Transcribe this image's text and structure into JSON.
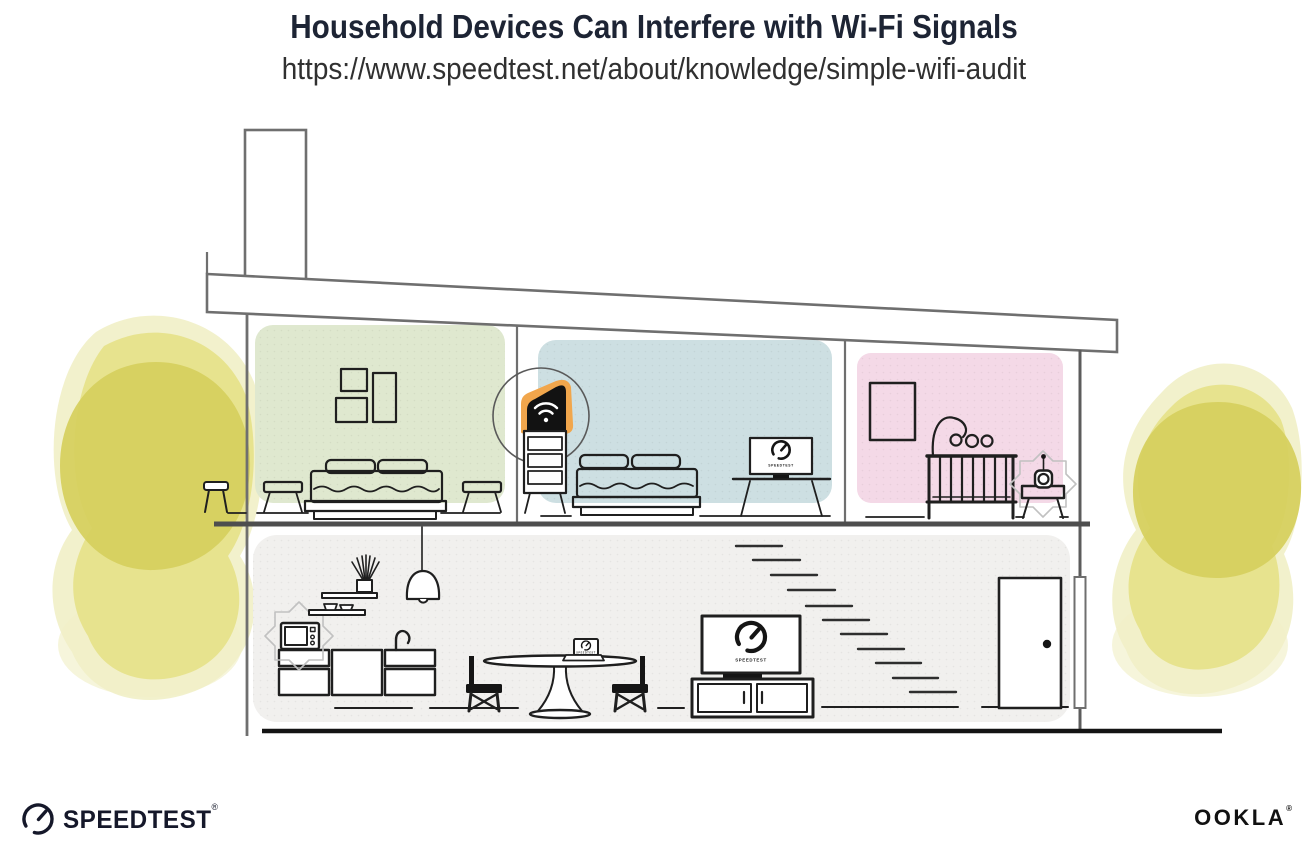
{
  "header": {
    "title": "Household Devices Can Interfere with Wi-Fi Signals",
    "url": "https://www.speedtest.net/about/knowledge/simple-wifi-audit"
  },
  "devices": {
    "tv_label": "SPEEDTEST",
    "desk_monitor_label": "SPEEDTEST",
    "laptop_label": "SPEEDTEST"
  },
  "footer": {
    "speedtest_wordmark": "SPEEDTEST",
    "speedtest_registered": "®",
    "ookla_wordmark": "OOKLA",
    "ookla_registered": "®"
  },
  "colors": {
    "title_text": "#1d2434",
    "url_text": "#303030",
    "outline_ink": "#1f1f1f",
    "wall_gray": "#6f6f6f",
    "room_green": "#dfe8cf",
    "room_blue": "#cddfe2",
    "room_pink": "#f4d9e7",
    "floor_gray": "#f1f0ee",
    "router_orange": "#f1a64c",
    "foliage_dark": "#d6d05f",
    "foliage_mid": "#e5e187",
    "foliage_light": "#f1efc7",
    "logo_ink": "#15182a"
  }
}
